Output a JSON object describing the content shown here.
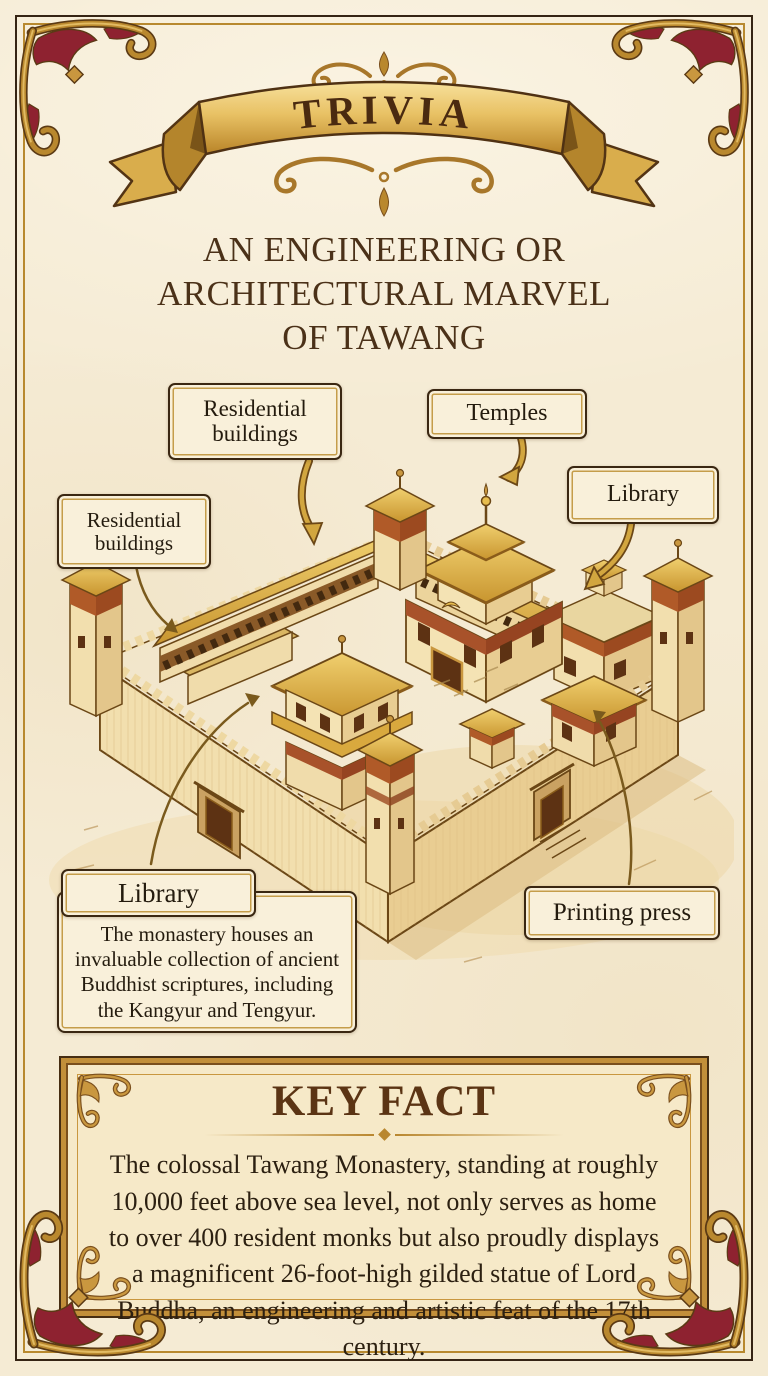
{
  "banner": {
    "title": "TRIVIA"
  },
  "header": {
    "title_lines": [
      "AN ENGINEERING OR",
      "ARCHITECTURAL MARVEL",
      "OF TAWANG"
    ]
  },
  "diagram": {
    "labels": {
      "residential_top": "Residential buildings",
      "residential_left": "Residential buildings",
      "temples": "Temples",
      "library_top": "Library",
      "library_callout_title": "Library",
      "library_callout_body": "The monastery houses an invaluable collection of ancient Buddhist scriptures, including the Kangyur and Tengyur.",
      "printing_press": "Printing press"
    }
  },
  "key_fact": {
    "title": "KEY FACT",
    "body": "The colossal Tawang Monastery, standing at roughly 10,000 feet above sea level, not only serves as home to over 400 resident monks but also proudly displays a magnificent 26-foot-high gilded statue of Lord Buddha, an engineering and artistic feat of the 17th century."
  },
  "colors": {
    "parchment": "#f5ebd4",
    "gold": "#c9973f",
    "gold_dark": "#8a5c1b",
    "maroon": "#8e2230",
    "ink": "#2c2011",
    "title_brown": "#4b3118"
  }
}
